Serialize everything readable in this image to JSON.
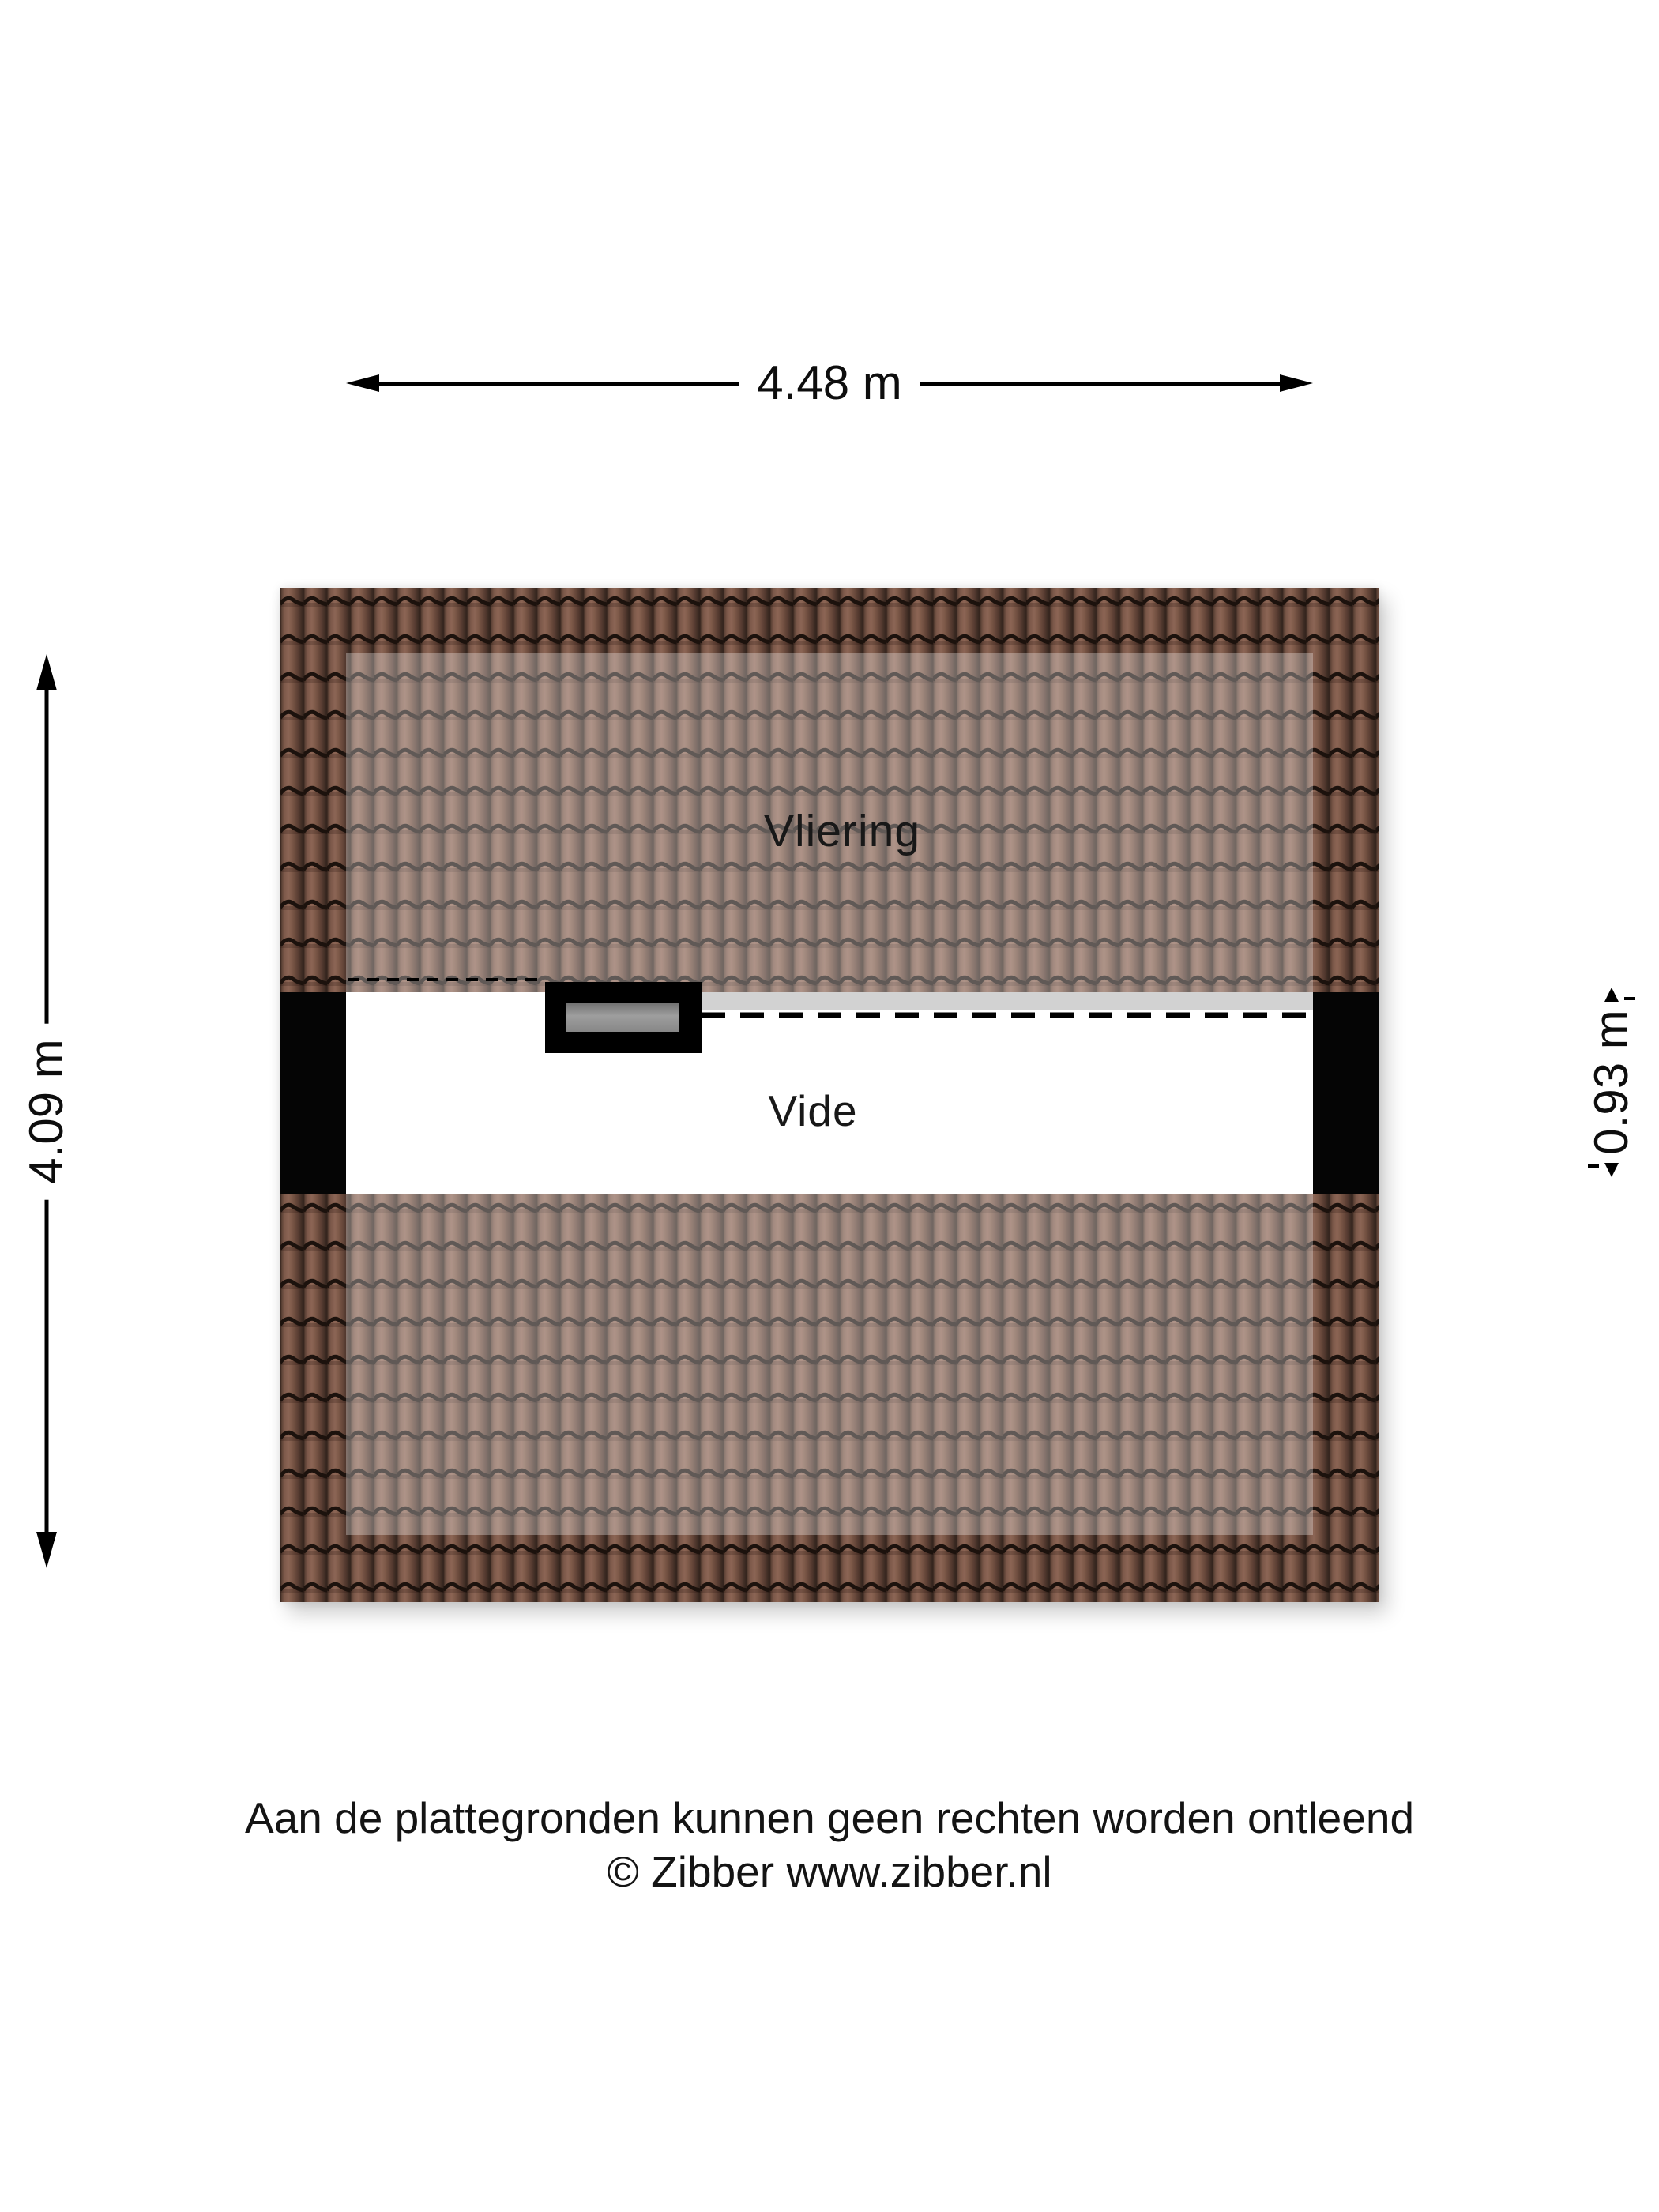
{
  "floorplan": {
    "labels": {
      "vliering": "Vliering",
      "vide": "Vide"
    },
    "dimensions": {
      "top": "4.48 m",
      "left": "4.09 m",
      "right": "0.93 m"
    },
    "footer": {
      "line1": "Aan de plattegronden kunnen geen rechten worden ontleend",
      "line2": "© Zibber www.zibber.nl"
    },
    "colors": {
      "tile_body": "#7b5849",
      "tile_line": "#1c120d",
      "roof_overlay": "rgba(255,255,255,0.30)",
      "wall": "#050505",
      "window_frame": "#000000",
      "window_glass": "#8f8f8f",
      "floor_strip": "#d2d2d2",
      "dimension": "#000000",
      "text": "#141414"
    }
  }
}
